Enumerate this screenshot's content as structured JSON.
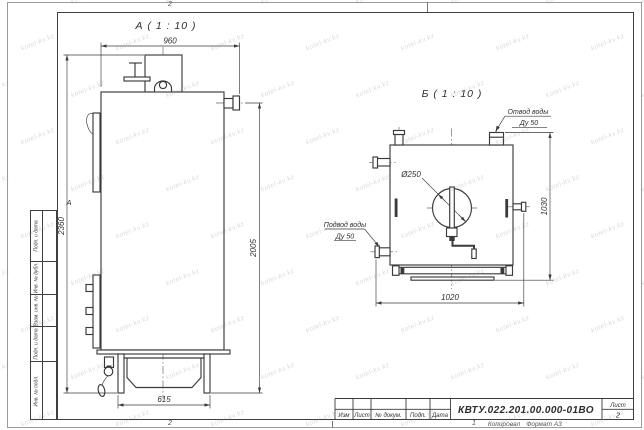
{
  "sheet": {
    "watermark_text": "kotel-kv.kz",
    "zones": {
      "top": "2",
      "bottom_left_num": "2",
      "bottom_right_num": "1",
      "row_letter": "А"
    },
    "footer": {
      "copied_label": "Копировал",
      "format_label": "Формат А3"
    }
  },
  "side_strip": {
    "cells": [
      {
        "label": "Подп. и дата"
      },
      {
        "label": "Инв. № дубл."
      },
      {
        "label": "Взам. инв. №"
      },
      {
        "label": "Подп. и дата"
      },
      {
        "label": "Инв. № подл."
      }
    ]
  },
  "view_a": {
    "title": "А ( 1 : 10 )",
    "dim_width": "960",
    "dim_height_total": "2360",
    "dim_height_body": "2005",
    "dim_base": "615"
  },
  "view_b": {
    "title": "Б ( 1 : 10 )",
    "dim_width": "1020",
    "dim_height": "1030",
    "dim_diameter": "Ø250",
    "outlet_line1": "Отвод воды",
    "outlet_line2": "Ду 50",
    "inlet_line1": "Подвод воды",
    "inlet_line2": "Ду 50"
  },
  "title_block": {
    "doc_number": "КВТУ.022.201.00.000-01ВО",
    "col_izm": "Изм",
    "col_list": "Лист",
    "col_doc": "№ докум.",
    "col_podp": "Подп.",
    "col_data": "Дата",
    "sheet_label": "Лист",
    "sheet_number": "2"
  }
}
